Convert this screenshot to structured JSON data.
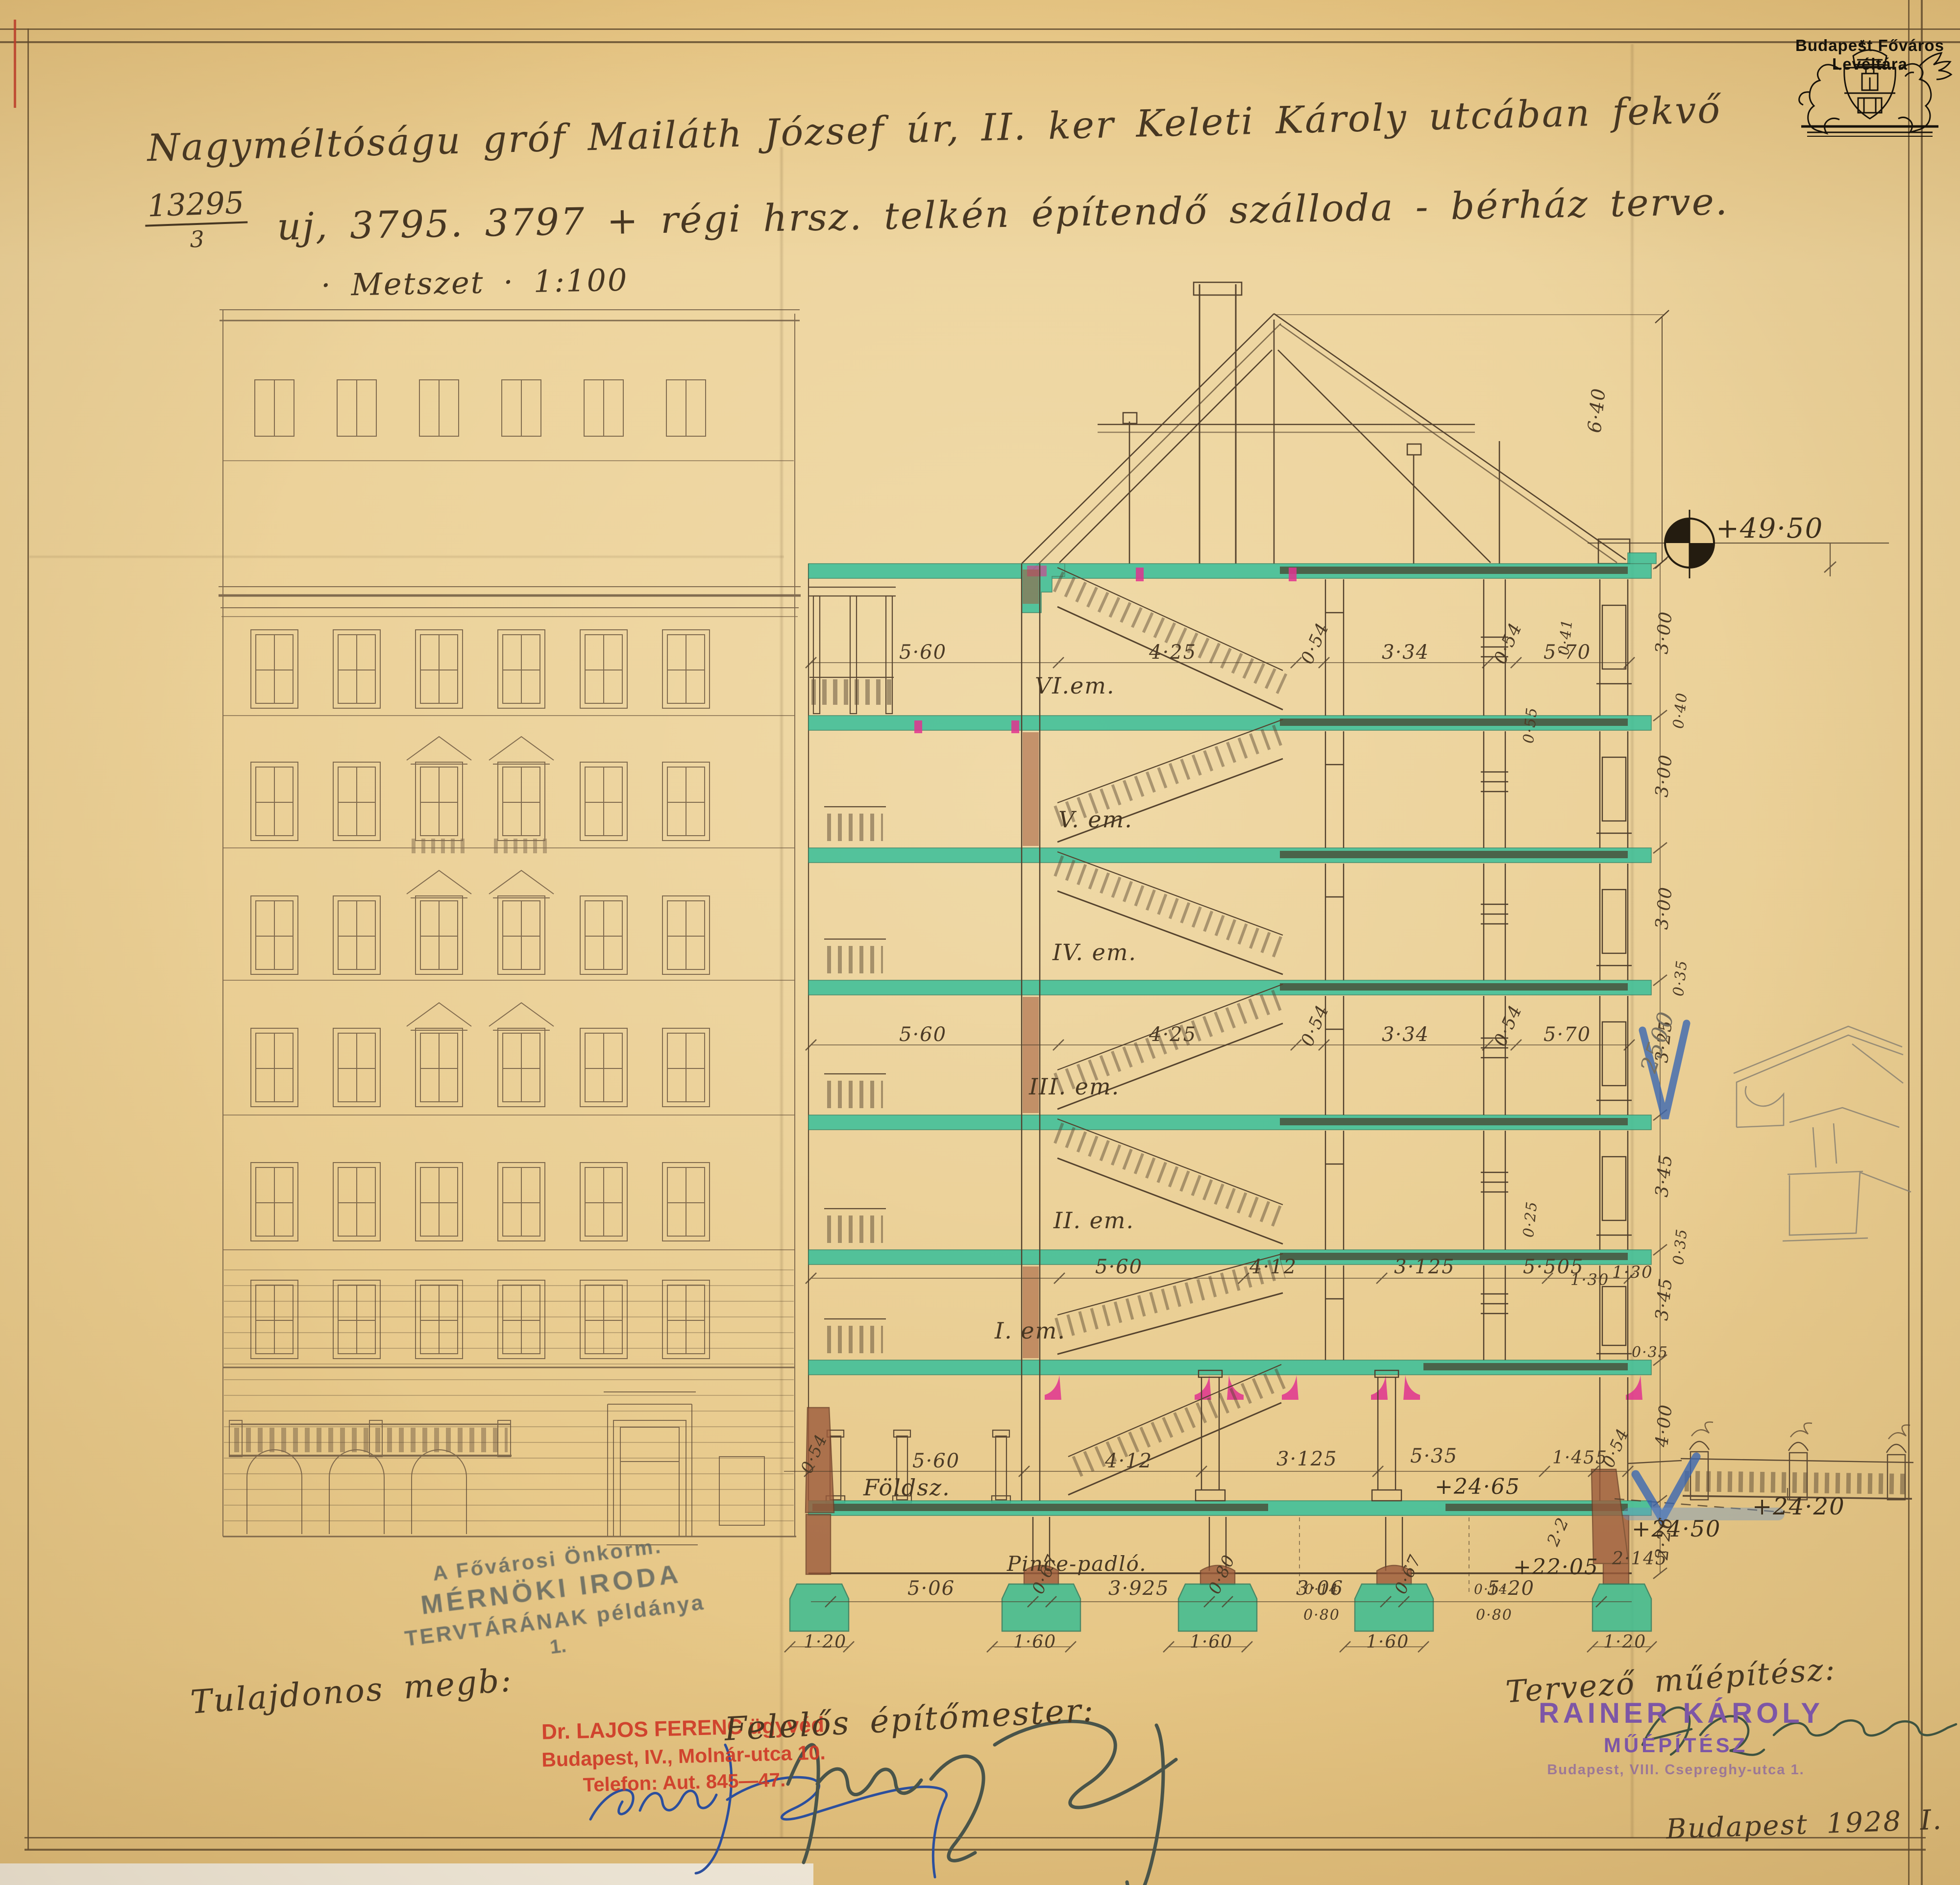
{
  "archive": {
    "label": "Budapest Főváros Levéltára"
  },
  "title": {
    "line1": "Nagyméltóságu gróf Mailáth József úr, II. ker Keleti Károly utcában fekvő",
    "lot_numerator": "13295",
    "lot_denominator": "3",
    "line2": "uj, 3795. 3797 + régi hrsz. telkén építendő szálloda - bérház terve.",
    "line3": "· Metszet · 1:100"
  },
  "floors": {
    "labels": [
      "VI.em.",
      "V. em.",
      "IV. em.",
      "III. em.",
      "II. em.",
      "I. em."
    ],
    "ground": "Földsz.",
    "basement": "Pince-padló."
  },
  "dims": {
    "attic_row": [
      "5·60",
      "4·25",
      "0·54",
      "3·34",
      "0·54",
      "5·70"
    ],
    "third_row": [
      "5·60",
      "4·25",
      "0·54",
      "3·34",
      "0·54",
      "5·70"
    ],
    "first_row": [
      "5·60",
      "4·12",
      "3·125",
      "5·505",
      "1·30"
    ],
    "ground_row": [
      "0·54",
      "5·60",
      "4·12",
      "3·125",
      "5·35",
      "1·455",
      "0·54"
    ],
    "basement_row": [
      "5·06",
      "0·67",
      "3·925",
      "0·80",
      "3·06",
      "0·67",
      "5·20",
      "2·2",
      "2·145"
    ],
    "footing_row": [
      "1·20",
      "1·60",
      "1·60",
      "1·60",
      "1·20"
    ],
    "right_chain": [
      "3·00",
      "3·00",
      "3·00",
      "3·25",
      "3·45",
      "3·45",
      "4·00",
      "2·26"
    ],
    "slab_thickness": [
      "0·40",
      "0·35",
      "0·35",
      "0·35"
    ],
    "roof_height": "6·40",
    "misc": [
      "0·41",
      "1·30",
      "0·55",
      "0·25",
      "0·14",
      "0·80",
      "0·14",
      "0·80"
    ],
    "pencil_note": "2500"
  },
  "elevations": {
    "eaves": "+49·50",
    "ground": "+24·65",
    "terrace": "+24·50",
    "street": "+24·20",
    "cellar": "+22·05"
  },
  "stamps": {
    "office": {
      "line1": "A Fővárosi Önkorm.",
      "line2": "MÉRNÖKI IRODA",
      "line3": "TERVTÁRÁNAK példánya",
      "line4": "1."
    },
    "lawyer": {
      "line1": "Dr. LAJOS FERENC ügyvéd",
      "line2": "Budapest, IV., Molnár-utca 10.",
      "line3": "Telefon: Aut. 845—47."
    },
    "architect": {
      "line1": "RAINER KÁROLY",
      "line2": "MŰÉPÍTÉSZ",
      "line3": "Budapest, VIII. Csepreghy-utca 1."
    }
  },
  "labels": {
    "owner": "Tulajdonos megb:",
    "builder": "Felelős építőmester:",
    "architect": "Tervező műépítész:",
    "date": "Budapest 1928 I. 22."
  },
  "colors": {
    "paper": "#e9cd92",
    "ink": "#473722",
    "slab_green": "#3ec09a",
    "beam_dark": "#49523c",
    "corbel_magenta": "#e0338f",
    "brick": "#9c5b3c",
    "pencil_blue": "#3a67b2",
    "stamp_red": "#cf3a28",
    "stamp_purple": "#7d56a6"
  }
}
